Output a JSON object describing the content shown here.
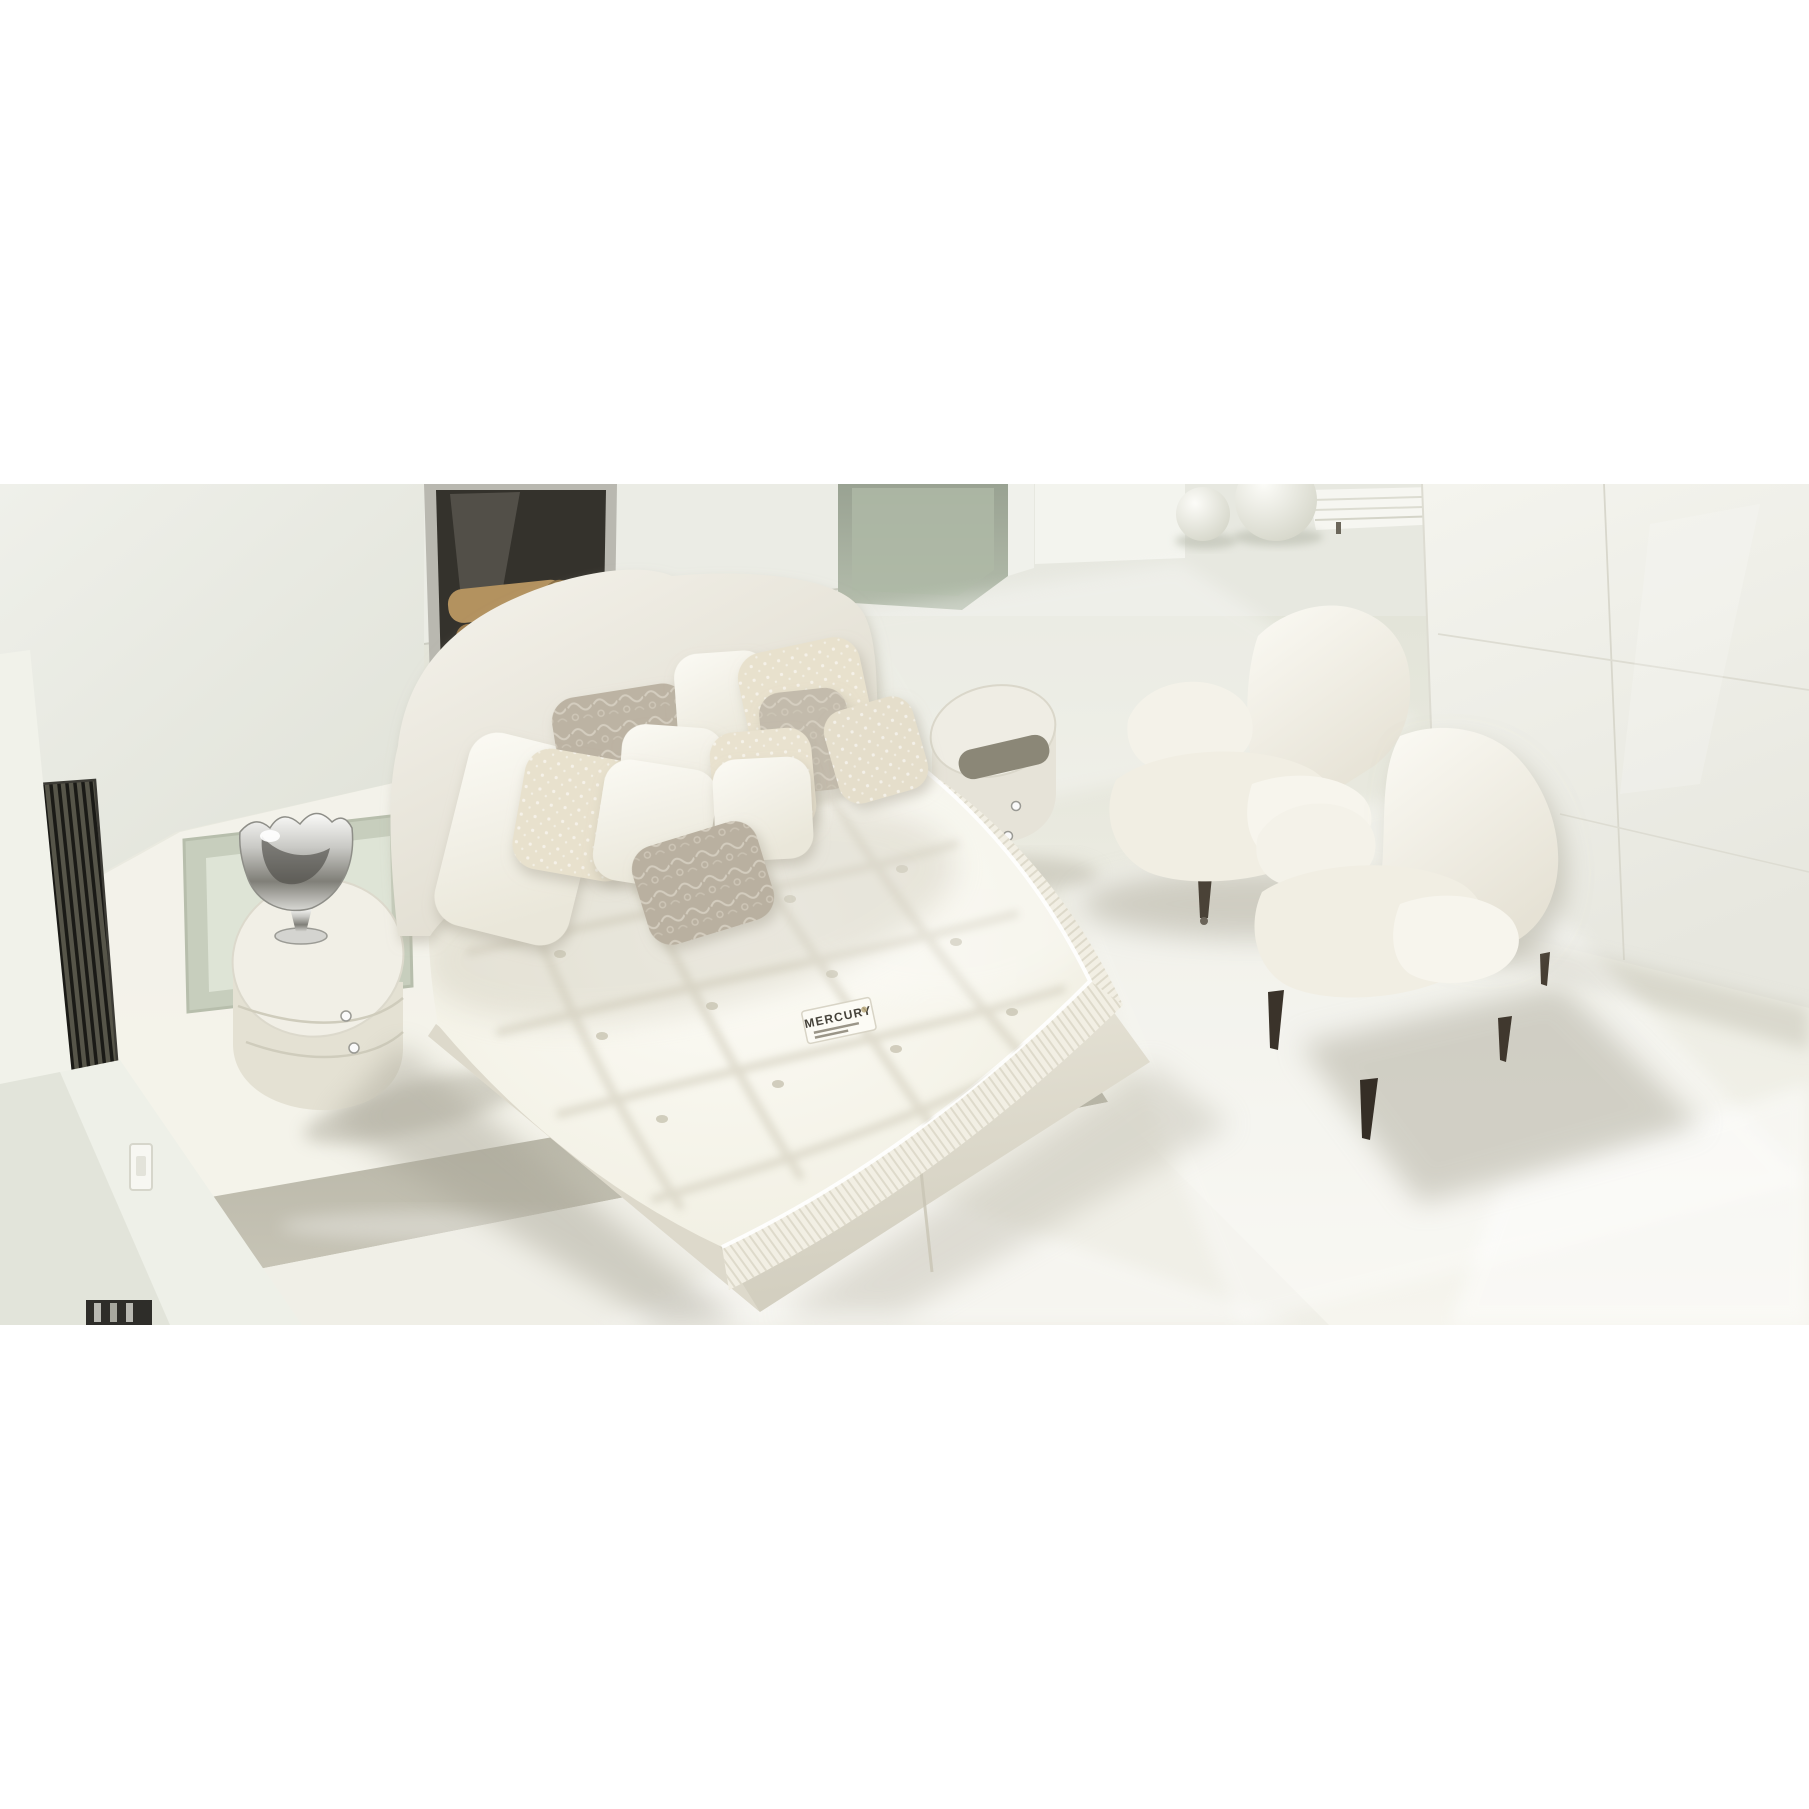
{
  "photo": {
    "subject": "Sunlit all-white bedroom: tufted mattress with MERCURY label on a divan bed with curved upholstered headboard and decorative pillows, round drum nightstands with crystal knobs, silver rose bowl, fireplace niche with firewood, sage glass partition, stone sphere decor, slatted bench, glossy white wardrobe and two white armchairs with dark turned legs",
    "mattress_label": {
      "brand": "MERCURY",
      "fine_print_lines": 2
    },
    "objects": [
      "tufted-mattress",
      "divan-base",
      "curved-headboard",
      "decorative-pillows",
      "nightstand-left",
      "silver-rose-bowl",
      "frosted-glass-floor-panel",
      "ventilation-grate",
      "fireplace-niche",
      "firewood-logs",
      "glass-partition",
      "stone-spheres",
      "slatted-bench",
      "glossy-wardrobe",
      "side-table-right",
      "armchair-left",
      "armchair-right",
      "wall-switch",
      "floor-socket"
    ]
  },
  "palette": {
    "page_background": "#ffffff",
    "wall": "#e8e9e1",
    "floor_far": "#dfe1d5",
    "floor_sunlit": "#f7f6ef",
    "step_gloss": "#b7b5a6",
    "mattress_white": "#fbfaf3",
    "upholstery_white": "#f6f4ec",
    "pillow_taupe": "#bcb3a3",
    "pillow_cream": "#e8e1cd",
    "firewood_tan": "#b3925f",
    "fireplace_dark": "#34322c",
    "glass_sage": "#a3ac9a",
    "chair_leg_brown": "#3a332a",
    "silver": "#c9c9c5",
    "label_text": "#45423a"
  }
}
